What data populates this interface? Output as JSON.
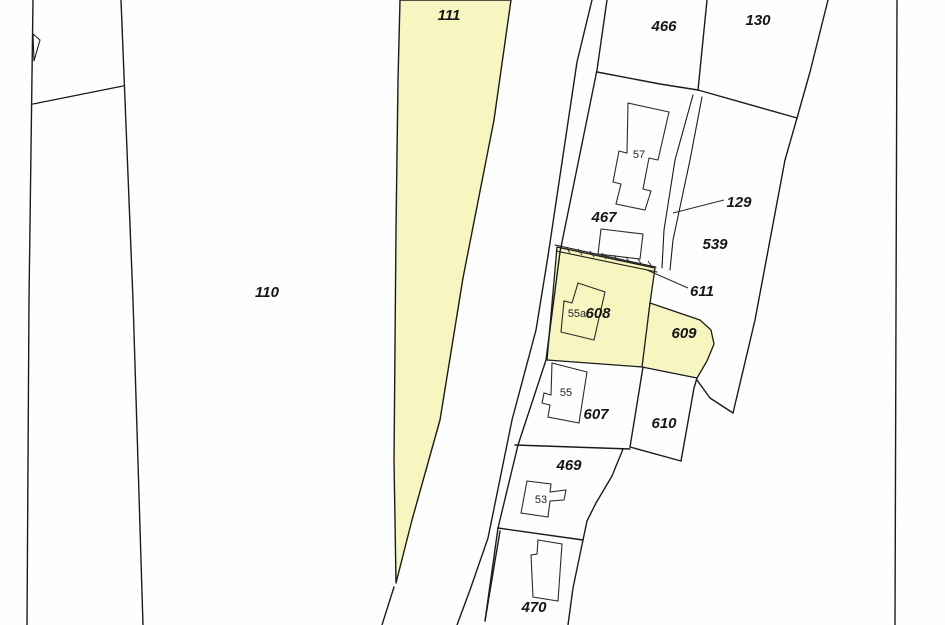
{
  "map": {
    "description": "Cadastral parcel map with highlighted parcels",
    "colors": {
      "highlight": "#f7f5c0",
      "line": "#1b1b1b",
      "paper": "#fefefe"
    },
    "parcel_labels": [
      {
        "id": "110",
        "text": "110"
      },
      {
        "id": "111",
        "text": "111"
      },
      {
        "id": "466",
        "text": "466"
      },
      {
        "id": "130",
        "text": "130"
      },
      {
        "id": "467",
        "text": "467"
      },
      {
        "id": "129",
        "text": "129"
      },
      {
        "id": "539",
        "text": "539"
      },
      {
        "id": "611",
        "text": "611"
      },
      {
        "id": "608",
        "text": "608"
      },
      {
        "id": "609",
        "text": "609"
      },
      {
        "id": "607",
        "text": "607"
      },
      {
        "id": "610",
        "text": "610"
      },
      {
        "id": "469",
        "text": "469"
      },
      {
        "id": "470",
        "text": "470"
      }
    ],
    "building_labels": [
      {
        "id": "57",
        "text": "57"
      },
      {
        "id": "55a",
        "text": "55a"
      },
      {
        "id": "55",
        "text": "55"
      },
      {
        "id": "53",
        "text": "53"
      }
    ]
  }
}
